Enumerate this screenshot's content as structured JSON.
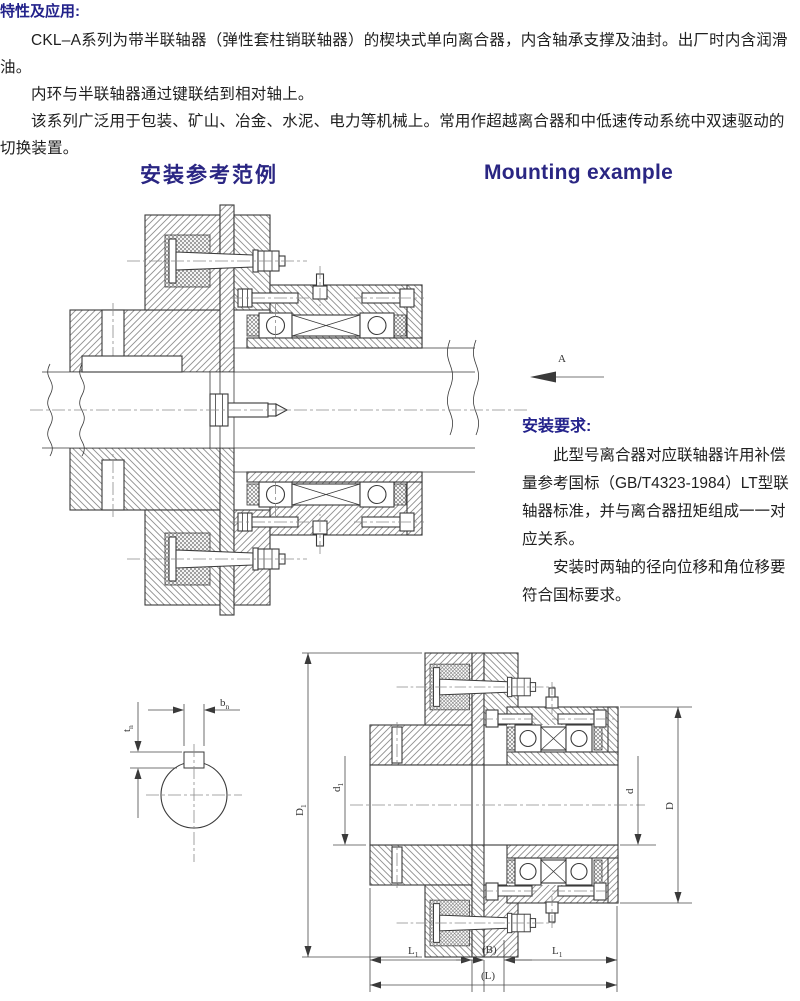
{
  "intro": {
    "heading": "特性及应用:",
    "paragraphs": [
      "CKL–A系列为带半联轴器（弹性套柱销联轴器）的楔块式单向离合器，内含轴承支撑及油封。出厂时内含润滑油。",
      "内环与半联轴器通过键联结到相对轴上。",
      "该系列广泛用于包装、矿山、冶金、水泥、电力等机械上。常用作超越离合器和中低速传动系统中双速驱动的切换装置。"
    ]
  },
  "section_titles": {
    "zh": "安装参考范例",
    "en": "Mounting example"
  },
  "view": {
    "label": "A"
  },
  "install_req": {
    "heading": "安装要求:",
    "paragraphs": [
      "此型号离合器对应联轴器许用补偿量参考国标（GB/T4323-1984）LT型联轴器标准，并与离合器扭矩组成一一对应关系。",
      "安装时两轴的径向位移和角位移要符合国标要求。"
    ]
  },
  "dims": {
    "flange_od": "D",
    "bore": "d",
    "housing_od": "D",
    "length_half": "L",
    "gap": "(B)",
    "length_total": "(L)",
    "key_width": "b",
    "key_depth": "t",
    "sub1": "1",
    "subn": "n"
  },
  "colors": {
    "accent": "#23228b",
    "text": "#202020",
    "line": "#3a3a3a"
  }
}
